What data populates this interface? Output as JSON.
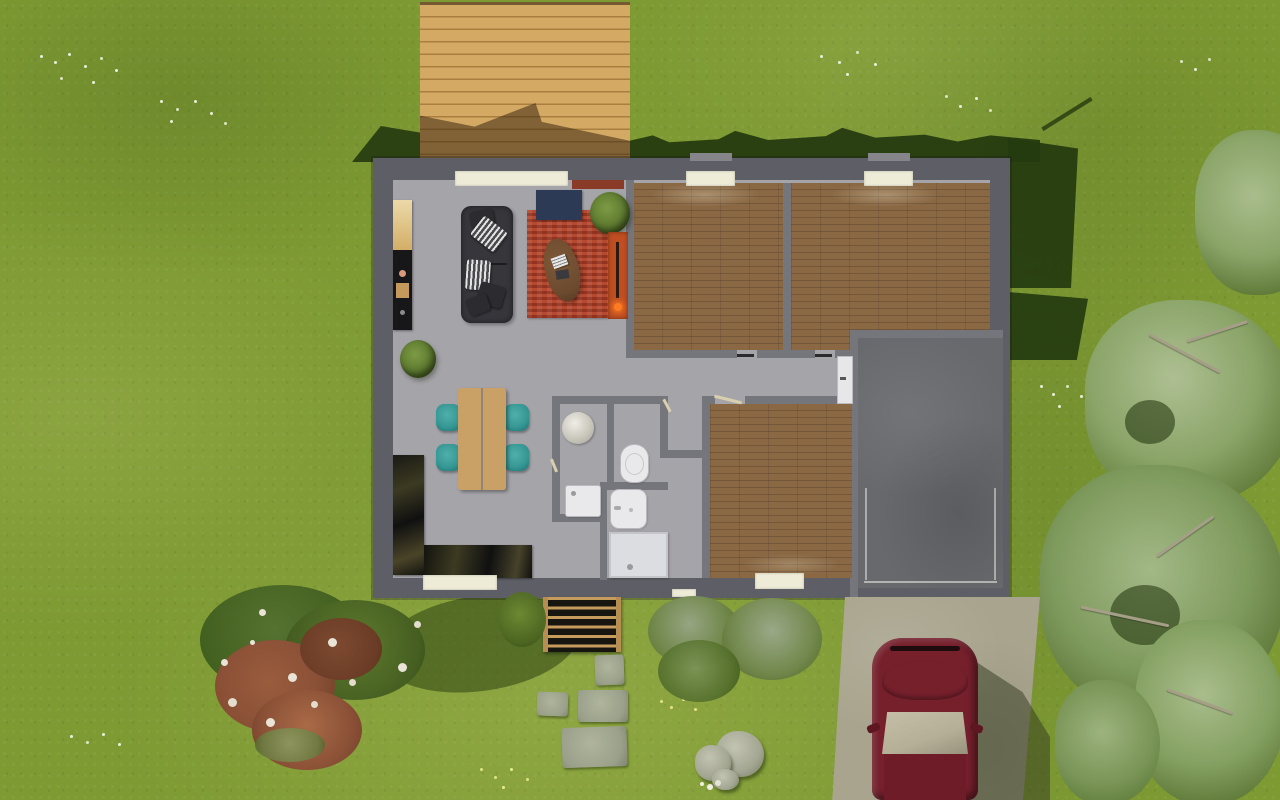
{
  "scene": {
    "description": "Top-down 3D architectural render of a single-storey house with furnished interior, garden lawn, wooden deck, entry path, driveway with parked car and trees",
    "rooms": [
      "living-room",
      "kitchen",
      "bedroom-1",
      "bedroom-2",
      "bedroom-3",
      "bathroom",
      "wc",
      "hallway",
      "garage"
    ],
    "outdoor_features": [
      "lawn",
      "wooden-deck",
      "house-shadow",
      "entry-slat-mat",
      "stepping-stones",
      "flowering-bush",
      "shrubs",
      "boulders",
      "driveway",
      "parked-car",
      "trees",
      "wildflowers"
    ],
    "furniture": [
      "sofa",
      "throw-pillows",
      "area-rug",
      "blue-door-mat",
      "coffee-table",
      "potted-plant",
      "wall-shelf",
      "wood-stove",
      "dining-table",
      "dining-chairs",
      "kitchen-wall-units",
      "kitchen-counter",
      "round-vanity",
      "washing-machine",
      "toilet",
      "washbasin",
      "shower-tray",
      "hall-cabinet"
    ]
  },
  "palette": {
    "grass": "#7e9a33",
    "grass_light": "#93ad42",
    "grass_dark": "#66802a",
    "shadow": "#24390f",
    "deck_wood": "#d3a964",
    "deck_gap": "#a97f3f",
    "wall": "#5e5f66",
    "inner_wall": "#75757c",
    "floor": "#a5a4a9",
    "wood_floor": "#8a6844",
    "wood_gap": "#74573a",
    "garage_floor": "#67696c",
    "window_cream": "#eeebd7",
    "sofa_dark": "#36363b",
    "rug_red": "#b54a31",
    "rug_red_dark": "#93321f",
    "mat_navy": "#2c3a55",
    "table_wood": "#c9a166",
    "chair_teal": "#359693",
    "stove_orange": "#bf4e22",
    "shelf_red": "#8a3b27",
    "counter_black": "#17171a",
    "fixture_white": "#e9e9ec",
    "car_maroon": "#76202c",
    "car_roof": "#6e1d28",
    "car_glass": "#b5af97",
    "driveway": "#a8a48d",
    "stone_gray": "#9aa08a",
    "rock_gray": "#a3a691",
    "canopy_green": "#8fa873",
    "canopy_dark": "#49621f",
    "bush_green_dark": "#42601f",
    "bush_green_mid": "#567231",
    "bush_red_brown": "#8a5036",
    "flower_white": "#e9eedb"
  }
}
